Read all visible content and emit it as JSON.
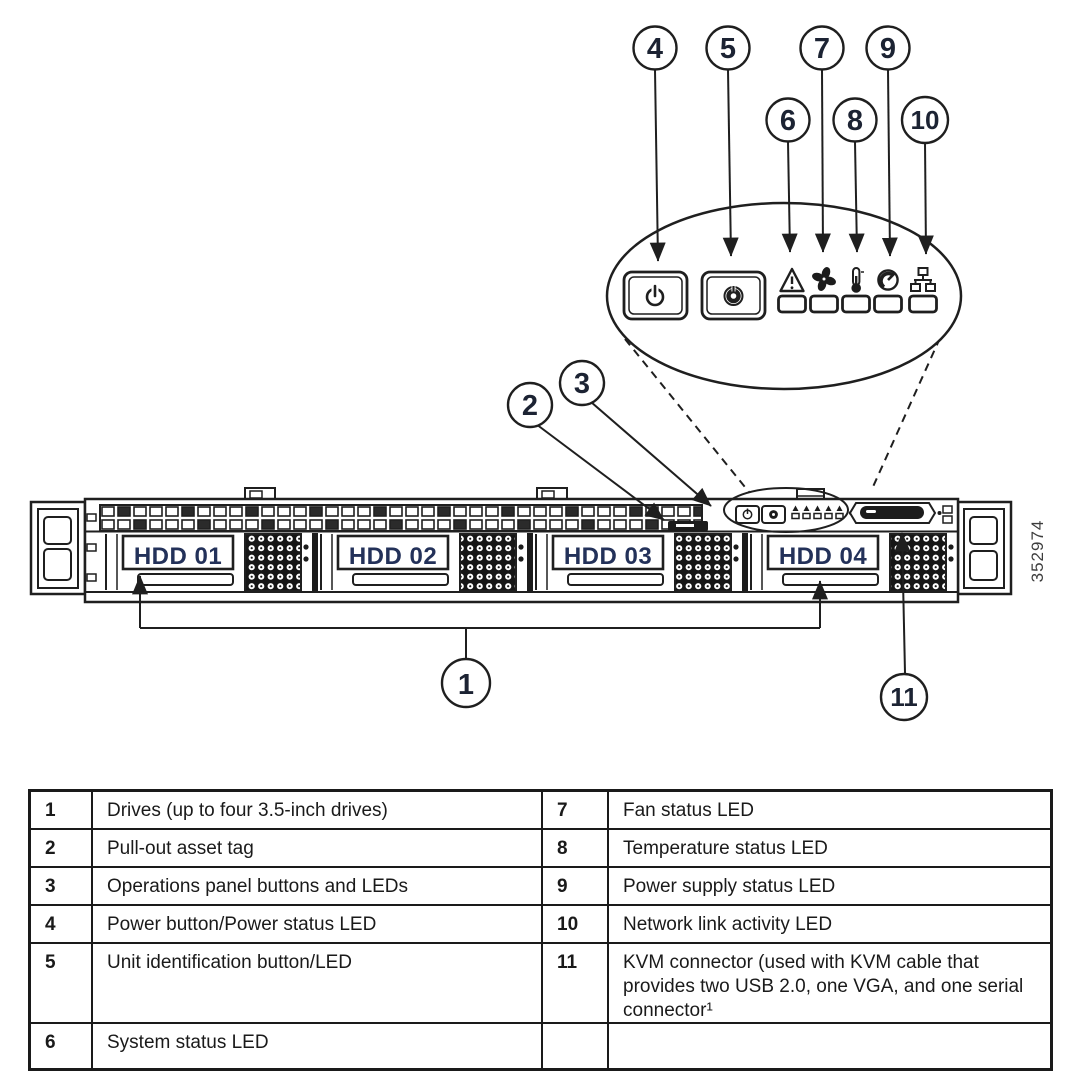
{
  "figure_number": "352974",
  "callouts": {
    "c1": "1",
    "c2": "2",
    "c3": "3",
    "c4": "4",
    "c5": "5",
    "c6": "6",
    "c7": "7",
    "c8": "8",
    "c9": "9",
    "c10": "10",
    "c11": "11"
  },
  "drives": {
    "d1": "HDD 01",
    "d2": "HDD 02",
    "d3": "HDD 03",
    "d4": "HDD 04"
  },
  "icons": [
    "power-icon",
    "unit-id-icon",
    "system-status-warning-icon",
    "fan-icon",
    "thermometer-icon",
    "power-supply-icon",
    "network-lan-icon"
  ],
  "legend": {
    "rows": [
      {
        "nl": "1",
        "dl": "Drives (up to four 3.5-inch drives)",
        "nr": "7",
        "dr": "Fan status LED"
      },
      {
        "nl": "2",
        "dl": "Pull-out asset tag",
        "nr": "8",
        "dr": "Temperature status LED"
      },
      {
        "nl": "3",
        "dl": "Operations panel buttons and LEDs",
        "nr": "9",
        "dr": "Power supply status LED"
      },
      {
        "nl": "4",
        "dl": "Power button/Power status LED",
        "nr": "10",
        "dr": "Network link activity LED"
      },
      {
        "nl": "5",
        "dl": "Unit identification button/LED",
        "nr": "11",
        "dr": "KVM connector (used with KVM cable that provides two USB 2.0, one VGA, and one serial connector¹"
      },
      {
        "nl": "6",
        "dl": "System status LED",
        "nr": "",
        "dr": ""
      }
    ]
  },
  "colors": {
    "line": "#1f1f1f",
    "text": "#1a1a1a",
    "hdd_label": "#233159",
    "dark_fill": "#1c1c1c"
  }
}
